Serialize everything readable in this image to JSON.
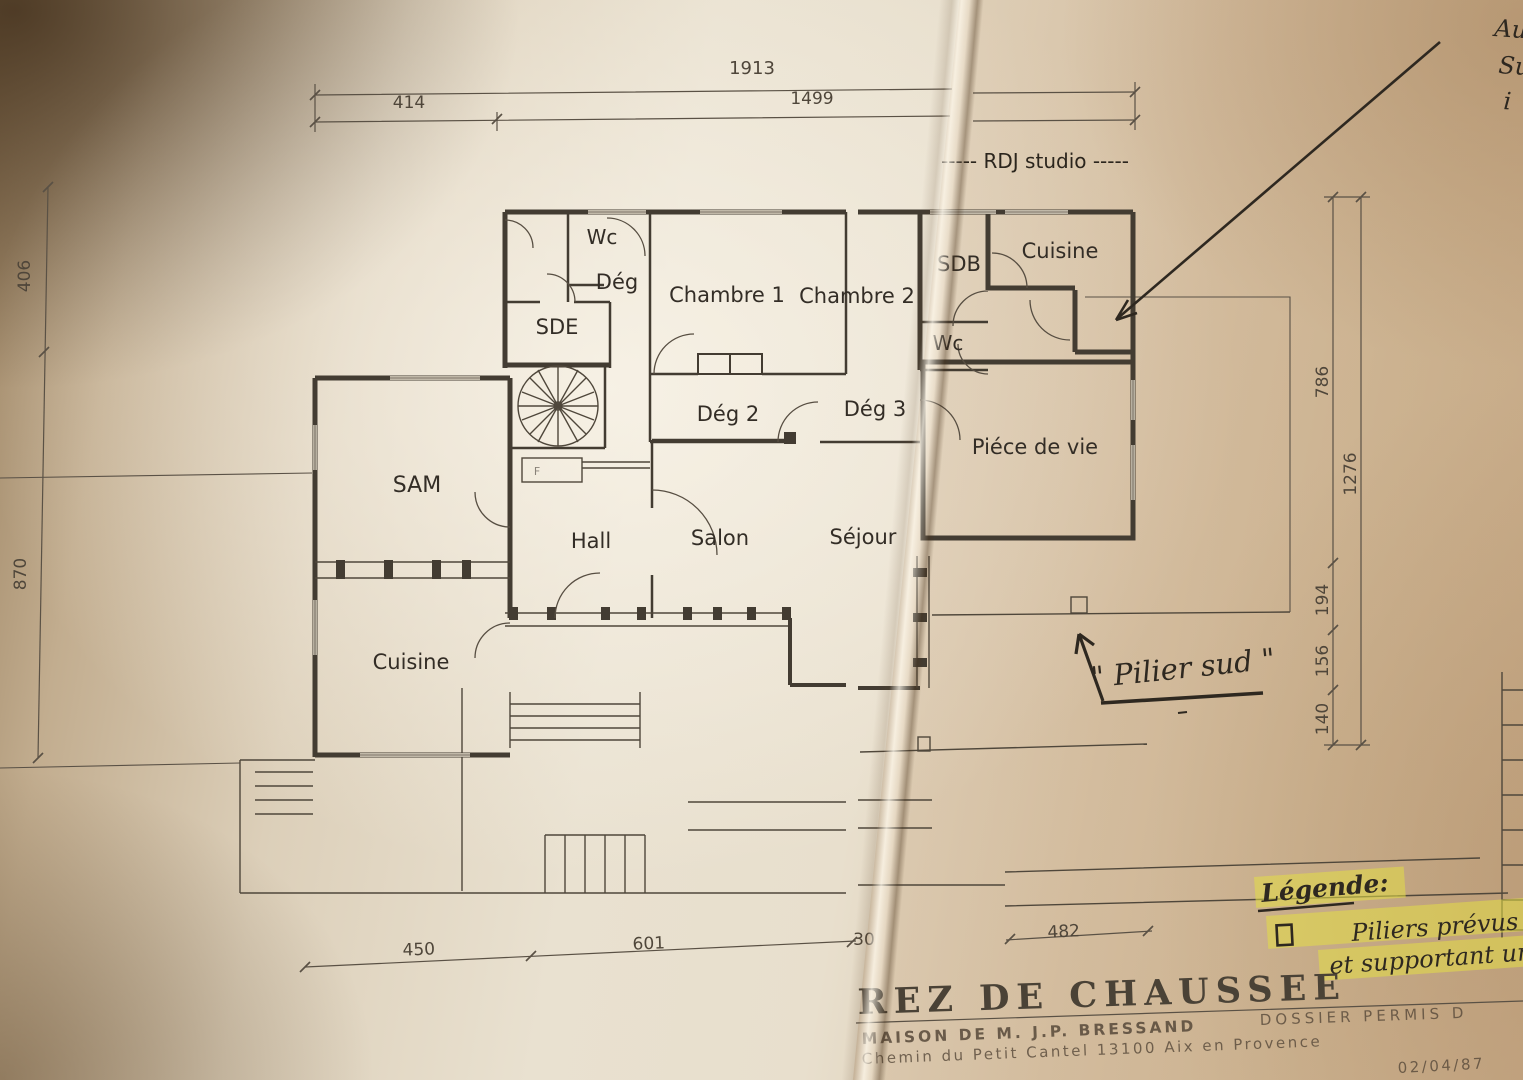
{
  "colors": {
    "paper_light": "#e9e1d0",
    "paper_shadow": "#99805f",
    "ink": "#2e2820",
    "plan_line": "#433c32",
    "highlight_yellow": "#e4de45"
  },
  "plan": {
    "studio_header": "-----  RDJ studio  -----",
    "rooms": {
      "wc_top": "Wc",
      "deg": "Dég",
      "chambre1": "Chambre 1",
      "chambre2": "Chambre 2",
      "sdb": "SDB",
      "cuisine_studio": "Cuisine",
      "sde": "SDE",
      "wc_studio": "Wc",
      "deg2": "Dég 2",
      "deg3": "Dég 3",
      "piece_de_vie": "Piéce de vie",
      "sam": "SAM",
      "hall": "Hall",
      "salon": "Salon",
      "sejour": "Séjour",
      "cuisine_main": "Cuisine"
    },
    "stair_box_label": "F"
  },
  "dimensions": {
    "top": {
      "total": "1913",
      "left": "414",
      "right": "1499"
    },
    "left": {
      "upper": "406",
      "lower": "870"
    },
    "right": {
      "seg1": "786",
      "total": "1276",
      "seg2": "194",
      "seg3": "156",
      "seg4": "140"
    },
    "bottom": {
      "d1": "450",
      "d2": "601",
      "d3": "30",
      "d4": "482"
    }
  },
  "handwriting": {
    "corner_fragment_1": "Au",
    "corner_fragment_2": "Su",
    "corner_fragment_3": "i",
    "pilier_sud": "\" Pilier sud \"",
    "legende_title": "Légende:",
    "legende_line1": "Piliers prévus",
    "legende_line2": "et supportant un é"
  },
  "title_block": {
    "title": "REZ DE CHAUSSEE",
    "owner": "MAISON DE M. J.P. BRESSAND",
    "address": "Chemin du Petit Cantel 13100 Aix en Provence",
    "dossier": "DOSSIER PERMIS D",
    "date": "02/04/87"
  }
}
